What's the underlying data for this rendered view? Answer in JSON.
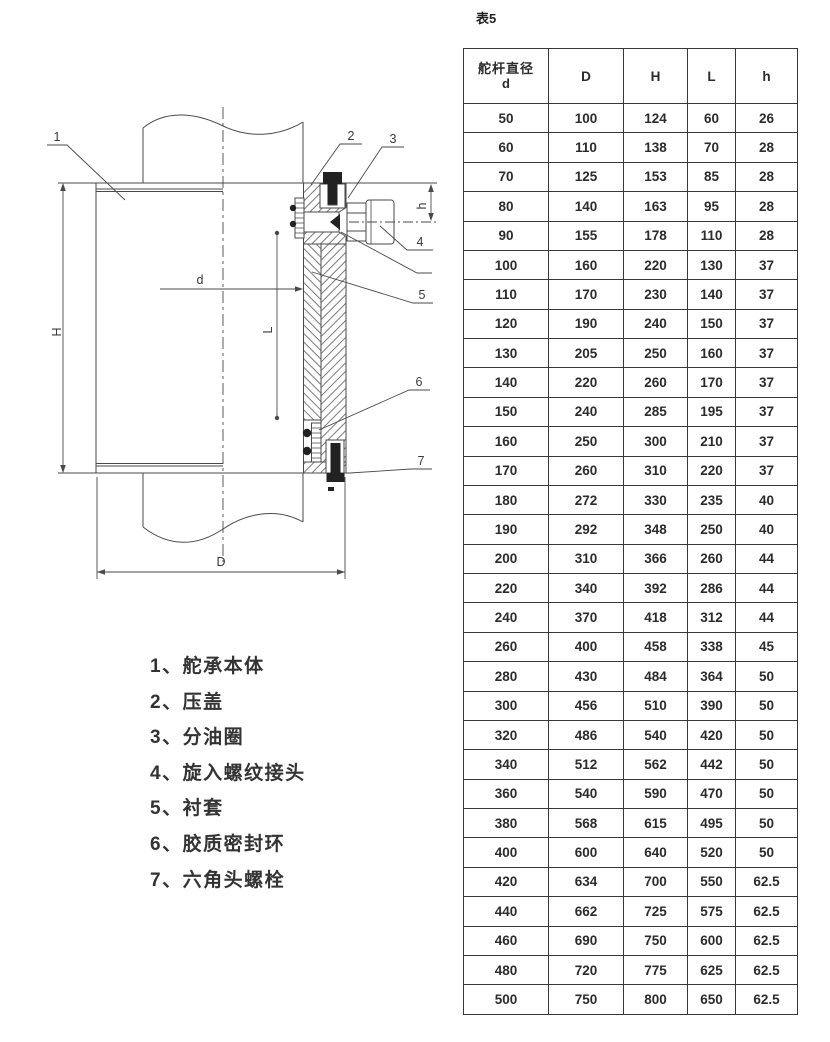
{
  "drawing": {
    "part_labels": {
      "n1": "1",
      "n2": "2",
      "n3": "3",
      "n4": "4",
      "n5": "5",
      "n6": "6",
      "n7": "7"
    },
    "dim_labels": {
      "H": "H",
      "D": "D",
      "d": "d",
      "L": "L",
      "h": "h"
    }
  },
  "legend": {
    "items": [
      "1、舵承本体",
      "2、压盖",
      "3、分油圈",
      "4、旋入螺纹接头",
      "5、衬套",
      "6、胶质密封环",
      "7、六角头螺栓"
    ]
  },
  "table": {
    "title": "表5",
    "header": {
      "col1_line1": "舵杆直径",
      "col1_line2": "d",
      "cols": [
        "D",
        "H",
        "L",
        "h"
      ]
    },
    "rows": [
      [
        50,
        100,
        124,
        60,
        26
      ],
      [
        60,
        110,
        138,
        70,
        28
      ],
      [
        70,
        125,
        153,
        85,
        28
      ],
      [
        80,
        140,
        163,
        95,
        28
      ],
      [
        90,
        155,
        178,
        110,
        28
      ],
      [
        100,
        160,
        220,
        130,
        37
      ],
      [
        110,
        170,
        230,
        140,
        37
      ],
      [
        120,
        190,
        240,
        150,
        37
      ],
      [
        130,
        205,
        250,
        160,
        37
      ],
      [
        140,
        220,
        260,
        170,
        37
      ],
      [
        150,
        240,
        285,
        195,
        37
      ],
      [
        160,
        250,
        300,
        210,
        37
      ],
      [
        170,
        260,
        310,
        220,
        37
      ],
      [
        180,
        272,
        330,
        235,
        40
      ],
      [
        190,
        292,
        348,
        250,
        40
      ],
      [
        200,
        310,
        366,
        260,
        44
      ],
      [
        220,
        340,
        392,
        286,
        44
      ],
      [
        240,
        370,
        418,
        312,
        44
      ],
      [
        260,
        400,
        458,
        338,
        45
      ],
      [
        280,
        430,
        484,
        364,
        50
      ],
      [
        300,
        456,
        510,
        390,
        50
      ],
      [
        320,
        486,
        540,
        420,
        50
      ],
      [
        340,
        512,
        562,
        442,
        50
      ],
      [
        360,
        540,
        590,
        470,
        50
      ],
      [
        380,
        568,
        615,
        495,
        50
      ],
      [
        400,
        600,
        640,
        520,
        50
      ],
      [
        420,
        634,
        700,
        550,
        62.5
      ],
      [
        440,
        662,
        725,
        575,
        62.5
      ],
      [
        460,
        690,
        750,
        600,
        62.5
      ],
      [
        480,
        720,
        775,
        625,
        62.5
      ],
      [
        500,
        750,
        800,
        650,
        62.5
      ]
    ]
  }
}
